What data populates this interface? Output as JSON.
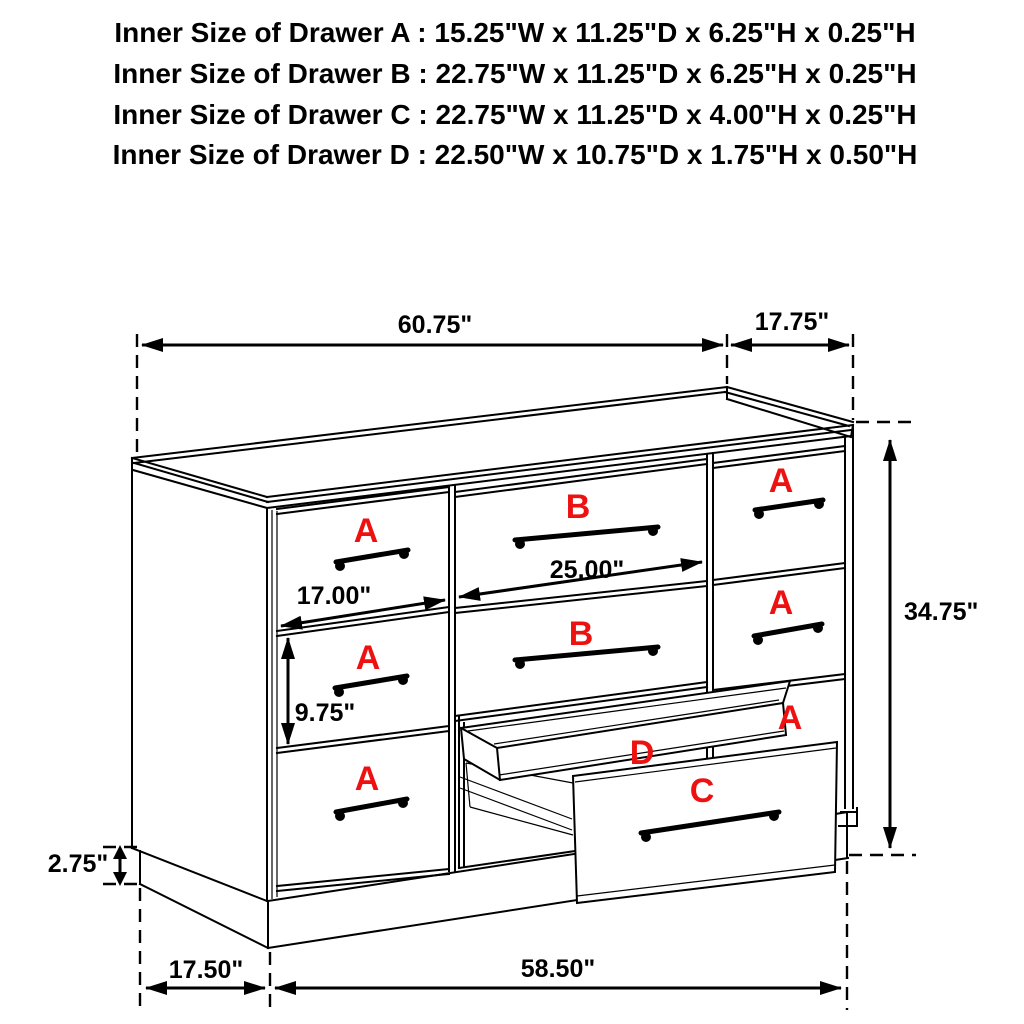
{
  "header": {
    "lines": [
      "Inner Size of Drawer A : 15.25\"W x 11.25\"D x 6.25\"H x 0.25\"H",
      "Inner Size of Drawer B : 22.75\"W x 11.25\"D x 6.25\"H x 0.25\"H",
      "Inner Size of Drawer C : 22.75\"W x 11.25\"D x 4.00\"H x 0.25\"H",
      "Inner Size of Drawer D : 22.50\"W x 10.75\"D x 1.75\"H x 0.50\"H"
    ]
  },
  "diagram": {
    "drawer_letters": {
      "left_top": "A",
      "left_middle": "A",
      "left_bottom": "A",
      "middle_top": "B",
      "middle_second": "B",
      "right_top": "A",
      "right_middle": "A",
      "right_lower": "A",
      "tray": "D",
      "pulled_drawer": "C"
    },
    "dimensions": {
      "top_width": "60.75\"",
      "top_depth": "17.75\"",
      "overall_height": "34.75\"",
      "drawer_a_width": "17.00\"",
      "drawer_b_width": "25.00\"",
      "drawer_section_height": "9.75\"",
      "base_height": "2.75\"",
      "floor_depth": "17.50\"",
      "floor_width": "58.50\""
    },
    "colors": {
      "letter_red": "#ee1111",
      "line": "#000000",
      "background": "#ffffff"
    }
  }
}
